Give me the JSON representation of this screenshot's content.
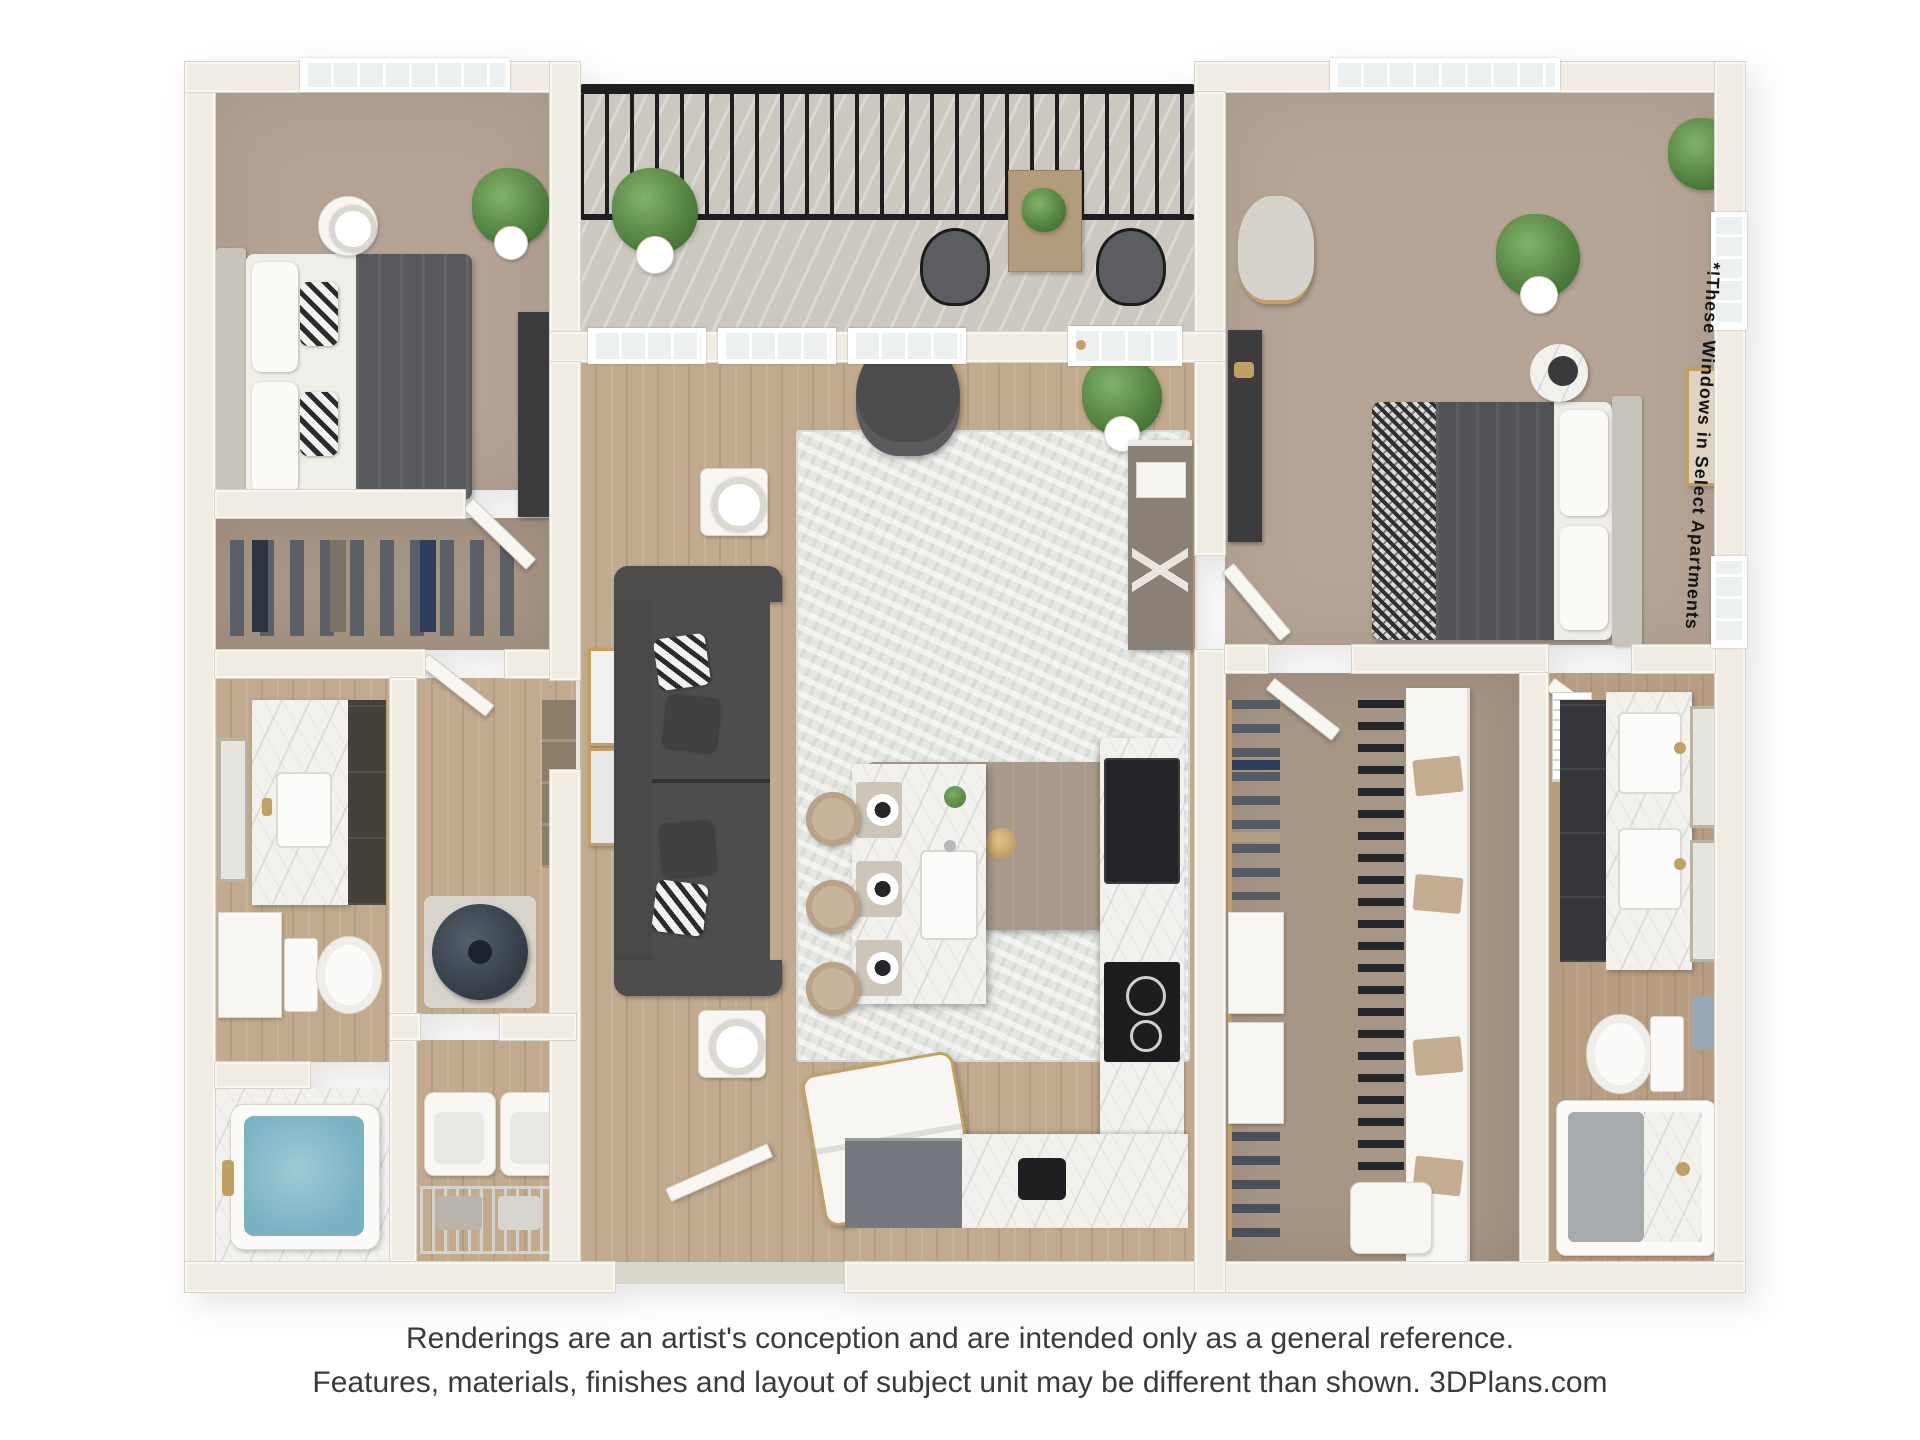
{
  "notes": {
    "windows_note": "*!These Windows in Select Apartments"
  },
  "disclaimer": {
    "line1": "Renderings are an artist's conception and are intended only as a general reference.",
    "line2": "Features, materials, finishes and layout of subject unit may be different than shown. 3DPlans.com"
  },
  "rooms": [
    "balcony",
    "bedroom-1",
    "living-room",
    "kitchen",
    "bedroom-2",
    "walk-in-closet",
    "reach-in-closet",
    "bathroom-1",
    "bathroom-2",
    "laundry-room",
    "utility-closet",
    "entry"
  ],
  "colors": {
    "wall": "#f0ece3",
    "wall_edge": "#d8d4ca",
    "wood": "#c1aa8e",
    "carpet1": "#b4a395",
    "carpet2": "#b6a597",
    "carpet3": "#a79585",
    "bath2floor": "#b89d82",
    "balcony": "#ccc8c0",
    "marble": "#f2f1ee",
    "rug": "#e4e7e2",
    "sofa": "#4d4d4f",
    "charcoal": "#3c3c3f",
    "blanket": "#57595c",
    "headboard": "#c8c4bc",
    "water": "#7ab2c2",
    "railing": "#1e1e1e",
    "gold": "#c2a065",
    "plant": "#5c8f4a",
    "appliance": "#242528",
    "graycab": "#75797f",
    "whitef": "#f7f6f2",
    "glass": "#edf0f1",
    "textmain": "#3a3a3a",
    "textnote": "#141414"
  }
}
